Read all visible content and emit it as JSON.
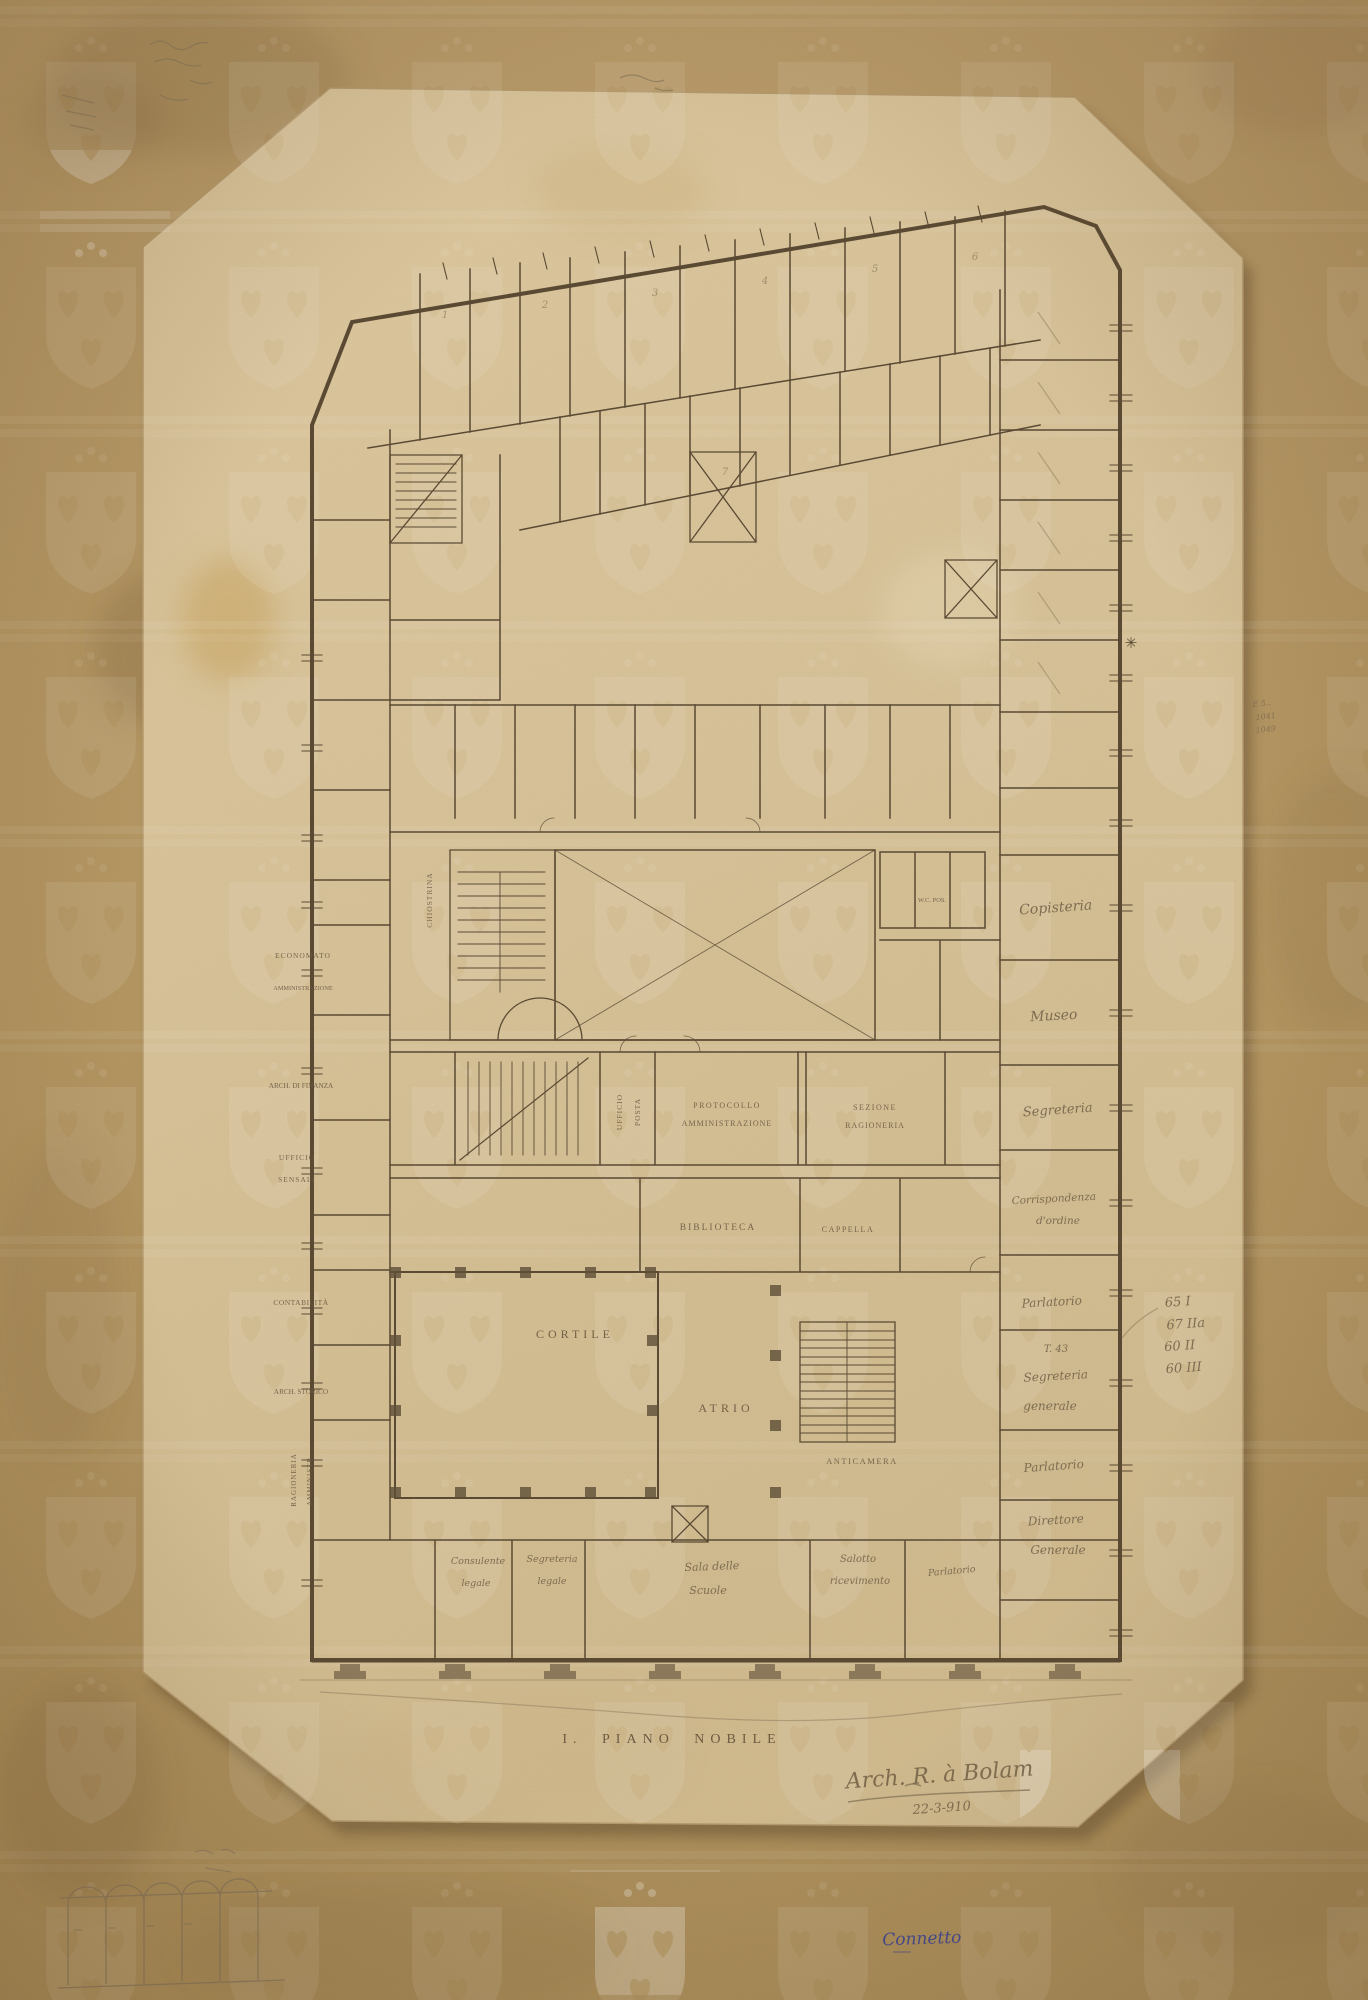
{
  "artwork": {
    "type": "hand-drawn architectural floor plan on aged paper",
    "floor_title": "I. PIANO NOBILE"
  },
  "labels": {
    "title": "I. PIANO NOBILE",
    "cortile": "CORTILE",
    "atrio": "ATRIO",
    "biblioteca": "BIBLIOTECA",
    "cappella": "CAPPELLA",
    "anticamera": "ANTICAMERA",
    "protocollo": [
      "PROTOCOLLO",
      "AMMINISTRAZIONE"
    ],
    "sezione": [
      "SEZIONE",
      "RAGIONERIA"
    ],
    "ufficio_posta": [
      "UFFICIO",
      "POSTA"
    ],
    "chiostrina": "CHIOSTRINA",
    "wc": "W.C. POS.",
    "left_wing": {
      "economato": [
        "ECONOMATO",
        "AMMINISTRAZIONE"
      ],
      "archivio_finanza": "ARCH. DI FINANZA",
      "ufficio_sensali": [
        "UFFICIO",
        "SENSALI"
      ],
      "contabilita": "CONTABILITÀ",
      "archivio_storico": "ARCH. STORICO",
      "ragioneria": [
        "RAGIONERIA",
        "AMMINISTR."
      ]
    },
    "right_wing": {
      "copisteria": "Copisteria",
      "museo": "Museo",
      "segreteria": "Segreteria",
      "corrispondenza": [
        "Corrispondenza",
        "d'ordine"
      ],
      "parlatorio_1": "Parlatorio",
      "segreteria_generale": [
        "T. 43",
        "Segreteria",
        "generale"
      ],
      "parlatorio_2": "Parlatorio",
      "direttore_generale": [
        "Direttore",
        "Generale"
      ]
    },
    "bottom_rooms": {
      "consulente_legale": [
        "Consulente",
        "legale"
      ],
      "segreteria_legale": [
        "Segreteria",
        "legale"
      ],
      "sala_scuole": [
        "Sala delle",
        "Scuole"
      ],
      "salotto_ricevimento": [
        "Salotto",
        "ricevimento"
      ],
      "parlatorio": "Parlatorio"
    },
    "room_numbers": [
      "1",
      "2",
      "3",
      "4",
      "5",
      "6",
      "7"
    ]
  },
  "annotations": {
    "signature": "Arch. R. à Bolam",
    "date": "22-3-910",
    "blue_note": "Connetto",
    "margin_codes": [
      "65 I",
      "67 IIa",
      "60 II",
      "60 III"
    ],
    "asterisk": "✳",
    "red_note": [
      "E 5..",
      "1041",
      "1049"
    ]
  },
  "palette": {
    "border_paper": "#b2945f",
    "sheet_paper": "#d9c49c",
    "ink": "#55452f",
    "pencil": "#8b7a5d",
    "blue_ink": "#3c4290"
  }
}
